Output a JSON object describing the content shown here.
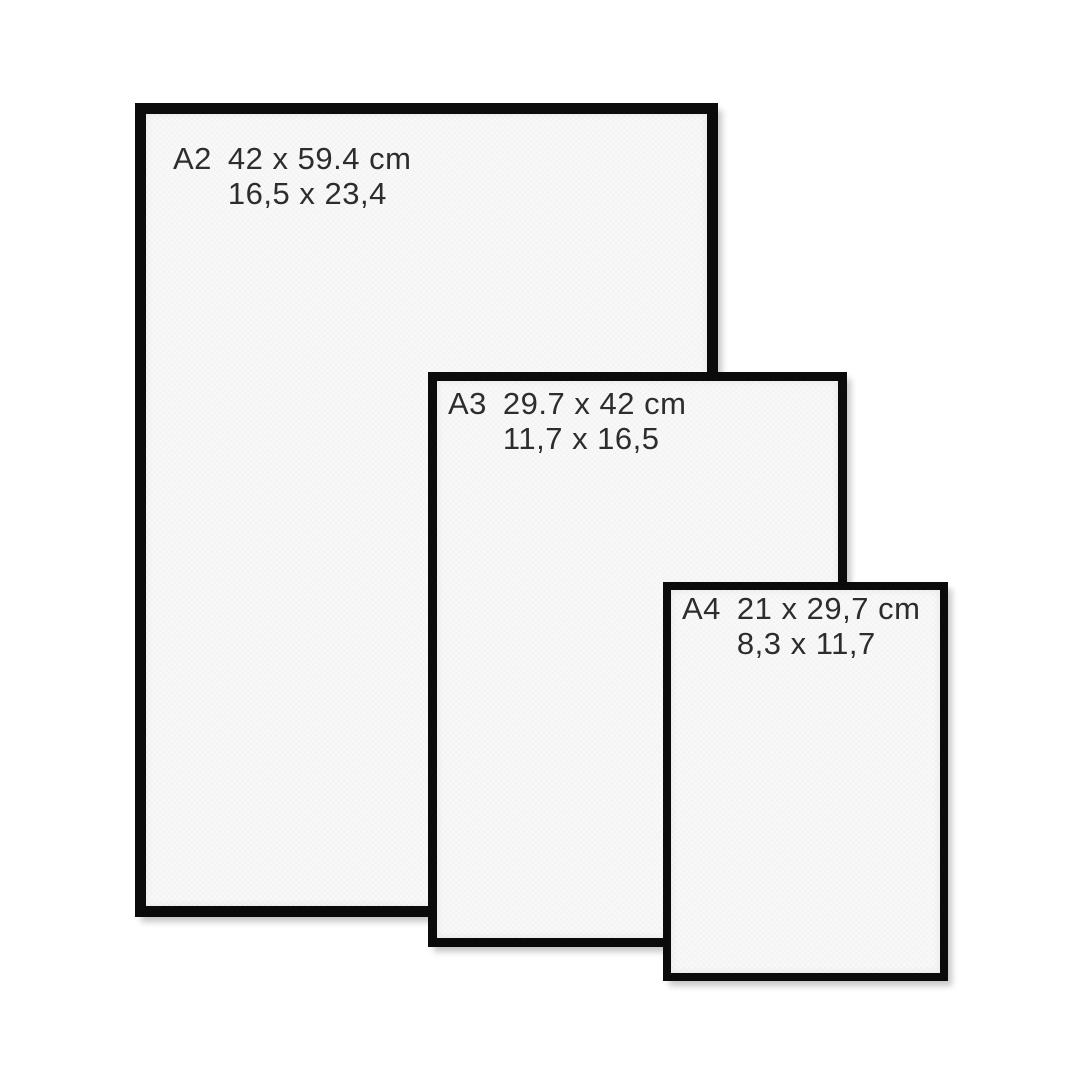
{
  "frames": [
    {
      "code": "A2",
      "cm": "42 x 59.4 cm",
      "inches": "16,5 x 23,4"
    },
    {
      "code": "A3",
      "cm": "29.7 x 42 cm",
      "inches": "11,7 x 16,5"
    },
    {
      "code": "A4",
      "cm": "21 x 29,7 cm",
      "inches": "8,3 x 11,7"
    }
  ],
  "colors": {
    "frame": "#0b0b0b",
    "paper": "#f9f9f9",
    "text": "#2d2d2d",
    "background": "#ffffff"
  }
}
